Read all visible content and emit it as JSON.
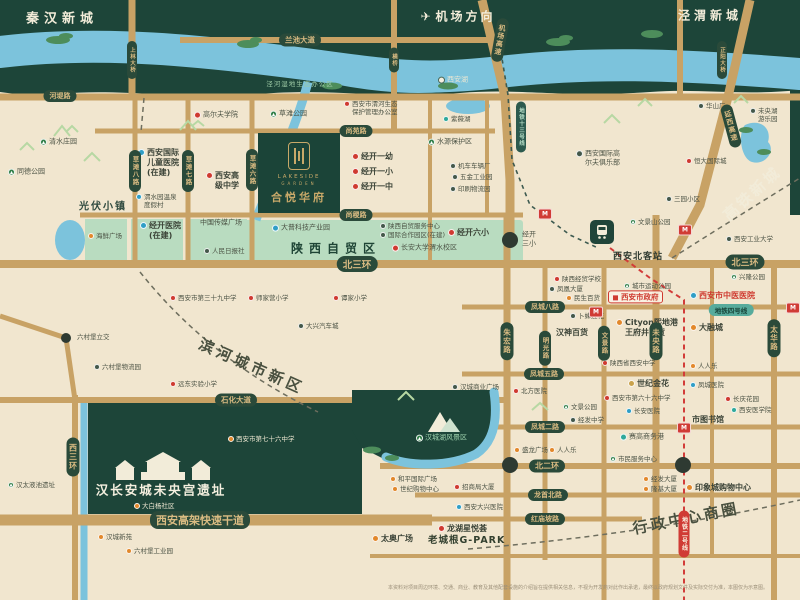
{
  "project": {
    "en_line1": "LAKESIDE",
    "en_line2": "GARDEN",
    "name_cn": "合悦华府"
  },
  "districts": {
    "qinhan": "秦汉新城",
    "jingwei": "泾渭新城",
    "airport_direction": "机场方向",
    "gaotie": "高铁新城",
    "binhe": "滨河城市新区",
    "xingzheng": "行政中心商圈",
    "zimao": "陕西自贸区",
    "guangfu": "光伏小镇",
    "ruins": "汉长安城未央宫遗址",
    "wetland_office": "泾河湿地生态办公区"
  },
  "station": {
    "name": "西安北客站",
    "icon": "train-icon"
  },
  "metro": {
    "line2": "地铁二号线",
    "line4": "地铁四号线",
    "line13": "地铁十三号线",
    "station_icon": "M"
  },
  "colors": {
    "cream": "#f1e6cf",
    "dark_green": "#1d4539",
    "mint": "#b9dcc0",
    "river": "#7cc3dc",
    "road": "#c8a265",
    "pill_green": "#2a4a3a",
    "pill_gold_text": "#d9bb82",
    "metro_red": "#d03b35",
    "metro_teal": "#57ab9c",
    "poi_red": "#cf3a30",
    "poi_orange": "#e2882b",
    "poi_blue": "#2f9ec6"
  },
  "road_pills_horizontal": [
    {
      "t": "兰池大道",
      "x": 300,
      "y": 40,
      "fs": 7.5
    },
    {
      "t": "河堤路",
      "x": 60,
      "y": 96,
      "fs": 7
    },
    {
      "t": "尚苑路",
      "x": 356,
      "y": 131,
      "fs": 7
    },
    {
      "t": "尚稷路",
      "x": 356,
      "y": 215,
      "fs": 7
    },
    {
      "t": "北三环",
      "x": 357,
      "y": 264,
      "fs": 9.5
    },
    {
      "t": "北三环",
      "x": 745,
      "y": 262,
      "fs": 9
    },
    {
      "t": "凤城八路",
      "x": 545,
      "y": 307,
      "fs": 7
    },
    {
      "t": "凤城五路",
      "x": 544,
      "y": 374,
      "fs": 7
    },
    {
      "t": "石化大道",
      "x": 236,
      "y": 400,
      "fs": 7.5
    },
    {
      "t": "凤城二路",
      "x": 545,
      "y": 427,
      "fs": 7
    },
    {
      "t": "北二环",
      "x": 547,
      "y": 466,
      "fs": 8
    },
    {
      "t": "龙首北路",
      "x": 548,
      "y": 495,
      "fs": 7
    },
    {
      "t": "红庙坡路",
      "x": 545,
      "y": 519,
      "fs": 7
    },
    {
      "t": "西安高架快速干道",
      "x": 200,
      "y": 520,
      "fs": 11
    }
  ],
  "road_pills_vertical": [
    {
      "t": "西三环",
      "x": 73,
      "y": 457,
      "fs": 8
    },
    {
      "t": "草滩八路",
      "x": 135,
      "y": 171,
      "fs": 6.5
    },
    {
      "t": "草滩七路",
      "x": 188,
      "y": 171,
      "fs": 6.5
    },
    {
      "t": "草滩六路",
      "x": 252,
      "y": 170,
      "fs": 6.5
    },
    {
      "t": "朱宏路",
      "x": 507,
      "y": 341,
      "fs": 7.5
    },
    {
      "t": "明光路",
      "x": 545,
      "y": 348,
      "fs": 6.5
    },
    {
      "t": "文景路",
      "x": 604,
      "y": 343,
      "fs": 6.5
    },
    {
      "t": "未央路",
      "x": 656,
      "y": 341,
      "fs": 7.5
    },
    {
      "t": "太华路",
      "x": 774,
      "y": 338,
      "fs": 7.5
    }
  ],
  "bridge_pills": [
    {
      "t": "上林大桥",
      "x": 132,
      "y": 60,
      "fs": 5.5
    },
    {
      "t": "横桥",
      "x": 394,
      "y": 60,
      "fs": 5.5
    },
    {
      "t": "正阳大桥",
      "x": 722,
      "y": 60,
      "fs": 5.5
    }
  ],
  "highway_pills": [
    {
      "t": "机场高速",
      "x": 500,
      "y": 40,
      "rot": 10,
      "fs": 7
    },
    {
      "t": "延西高速",
      "x": 731,
      "y": 126,
      "rot": -15,
      "fs": 7
    }
  ],
  "metro_pills": [
    {
      "t": "地铁二号线",
      "x": 684,
      "y": 534,
      "kind": "red",
      "vert": true,
      "fs": 6
    },
    {
      "t": "地铁四号线",
      "x": 731,
      "y": 310,
      "kind": "teal",
      "vert": false,
      "fs": 6.5
    },
    {
      "t": "地铁十三号线",
      "x": 521,
      "y": 127,
      "kind": "dteal",
      "vert": true,
      "fs": 5.5
    }
  ],
  "metro_stations": [
    [
      545,
      214
    ],
    [
      685,
      230
    ],
    [
      596,
      312
    ],
    [
      793,
      308
    ],
    [
      684,
      428
    ]
  ],
  "pois": [
    {
      "t": "清水庄园",
      "x": 40,
      "y": 142,
      "c": "green",
      "s": "sm"
    },
    {
      "t": "同德公园",
      "x": 8,
      "y": 172,
      "c": "green",
      "s": "sm"
    },
    {
      "t": "草滩公园",
      "x": 270,
      "y": 114,
      "c": "green",
      "s": "sm"
    },
    {
      "t": "高尔夫学院",
      "x": 194,
      "y": 115,
      "c": "red",
      "s": "sm"
    },
    {
      "L": [
        "西安国际",
        "儿童医院",
        "(在建)"
      ],
      "x": 138,
      "y": 163,
      "c": "blue",
      "s": "md"
    },
    {
      "L": [
        "西安高",
        "级中学"
      ],
      "x": 206,
      "y": 181,
      "c": "red",
      "s": "md"
    },
    {
      "L": [
        "渭水园温泉",
        "度假村"
      ],
      "x": 136,
      "y": 201,
      "c": "blue",
      "s": "xs"
    },
    {
      "t": "海鲜广场",
      "x": 88,
      "y": 236,
      "c": "orange",
      "s": "xs"
    },
    {
      "L": [
        "经开医院",
        "(在建)"
      ],
      "x": 140,
      "y": 231,
      "c": "blue",
      "s": "md"
    },
    {
      "t": "中国传媒广场",
      "x": 200,
      "y": 223,
      "c": "none",
      "s": "sm"
    },
    {
      "t": "人民日报社",
      "x": 204,
      "y": 251,
      "c": "dark",
      "s": "xs"
    },
    {
      "L": [
        "西安市渭河生态",
        "保护管理办公室"
      ],
      "x": 344,
      "y": 108,
      "c": "red",
      "s": "xs"
    },
    {
      "t": "西安湖",
      "x": 438,
      "y": 80,
      "c": "white",
      "s": "sm",
      "d": true
    },
    {
      "t": "紫薇湖",
      "x": 443,
      "y": 119,
      "c": "teal",
      "s": "xs"
    },
    {
      "t": "水源保护区",
      "x": 428,
      "y": 142,
      "c": "green",
      "s": "sm"
    },
    {
      "t": "机车车辆厂",
      "x": 450,
      "y": 166,
      "c": "dark",
      "s": "xs"
    },
    {
      "t": "五金工业园",
      "x": 452,
      "y": 177,
      "c": "dark",
      "s": "xs"
    },
    {
      "t": "印刷物流园",
      "x": 450,
      "y": 189,
      "c": "dark",
      "s": "xs"
    },
    {
      "L": [
        "西安国际高",
        "尔夫俱乐部"
      ],
      "x": 576,
      "y": 158,
      "c": "dark",
      "s": "sm"
    },
    {
      "L": [
        "未央湖",
        "游乐园"
      ],
      "x": 750,
      "y": 115,
      "c": "dark",
      "s": "xs"
    },
    {
      "t": "华山厂",
      "x": 698,
      "y": 106,
      "c": "dark",
      "s": "xs"
    },
    {
      "t": "恒大国际城",
      "x": 686,
      "y": 161,
      "c": "red",
      "s": "xs"
    },
    {
      "t": "三园小区",
      "x": 666,
      "y": 199,
      "c": "dark",
      "s": "xs"
    },
    {
      "t": "西安工业大学",
      "x": 726,
      "y": 239,
      "c": "dark",
      "s": "xs"
    },
    {
      "t": "经开一幼",
      "x": 352,
      "y": 157,
      "c": "red",
      "s": "md"
    },
    {
      "t": "经开一小",
      "x": 352,
      "y": 172,
      "c": "red",
      "s": "md"
    },
    {
      "t": "经开一中",
      "x": 352,
      "y": 187,
      "c": "red",
      "s": "md"
    },
    {
      "t": "经开六小",
      "x": 448,
      "y": 233,
      "c": "red",
      "s": "md"
    },
    {
      "t": "长安大学渭水校区",
      "x": 392,
      "y": 248,
      "c": "red",
      "s": "sm"
    },
    {
      "t": "大普科技产业园",
      "x": 272,
      "y": 228,
      "c": "blue",
      "s": "sm"
    },
    {
      "t": "陕西自贸服务中心",
      "x": 380,
      "y": 226,
      "c": "dark",
      "s": "xs"
    },
    {
      "t": "国际合作园区(在建)",
      "x": 380,
      "y": 235,
      "c": "dark",
      "s": "xs"
    },
    {
      "L": [
        "经开",
        "三小"
      ],
      "x": 522,
      "y": 239,
      "c": "none",
      "s": "sm"
    },
    {
      "t": "文景山公园",
      "x": 630,
      "y": 222,
      "c": "green",
      "s": "xs"
    },
    {
      "t": "陕西经贸学校",
      "x": 554,
      "y": 279,
      "c": "red",
      "s": "xs"
    },
    {
      "t": "凤凰大厦",
      "x": 549,
      "y": 289,
      "c": "dark",
      "s": "xs"
    },
    {
      "t": "民生百货",
      "x": 566,
      "y": 298,
      "c": "orange",
      "s": "xs"
    },
    {
      "t": "卜蜂莲花",
      "x": 570,
      "y": 316,
      "c": "dark",
      "s": "xs"
    },
    {
      "t": "汉神百货",
      "x": 556,
      "y": 333,
      "c": "none",
      "s": "md"
    },
    {
      "t": "城市运动公园",
      "x": 624,
      "y": 286,
      "c": "green",
      "s": "xs"
    },
    {
      "t": "西安市政府",
      "x": 608,
      "y": 297,
      "c": "govt",
      "s": "govt"
    },
    {
      "t": "西安市中医医院",
      "x": 690,
      "y": 296,
      "c": "blue",
      "s": "redmd"
    },
    {
      "t": "兴隆公园",
      "x": 731,
      "y": 277,
      "c": "green",
      "s": "xs"
    },
    {
      "L": [
        "Cityon熙地港",
        "王府井百货"
      ],
      "x": 616,
      "y": 328,
      "c": "orange",
      "s": "md"
    },
    {
      "t": "大融城",
      "x": 690,
      "y": 328,
      "c": "orange",
      "s": "md"
    },
    {
      "t": "人人乐",
      "x": 690,
      "y": 366,
      "c": "orange",
      "s": "xs"
    },
    {
      "t": "陕西省西安中学",
      "x": 602,
      "y": 363,
      "c": "red",
      "s": "xs"
    },
    {
      "t": "世纪金花",
      "x": 628,
      "y": 384,
      "c": "goldc",
      "s": "md"
    },
    {
      "t": "凤城医院",
      "x": 690,
      "y": 385,
      "c": "blue",
      "s": "xs"
    },
    {
      "t": "长安医院",
      "x": 626,
      "y": 411,
      "c": "blue",
      "s": "xs"
    },
    {
      "t": "西安市第六十六中学",
      "x": 604,
      "y": 398,
      "c": "red",
      "s": "xs"
    },
    {
      "t": "长庆花园",
      "x": 725,
      "y": 399,
      "c": "red",
      "s": "xs"
    },
    {
      "t": "西安医学院",
      "x": 731,
      "y": 410,
      "c": "teal",
      "s": "xs"
    },
    {
      "t": "市图书馆",
      "x": 692,
      "y": 420,
      "c": "none",
      "s": "md"
    },
    {
      "t": "赛高商务港",
      "x": 620,
      "y": 437,
      "c": "teal",
      "s": "sm"
    },
    {
      "t": "市民服务中心",
      "x": 610,
      "y": 459,
      "c": "green",
      "s": "xs"
    },
    {
      "t": "经发大厦",
      "x": 643,
      "y": 479,
      "c": "orange",
      "s": "xs"
    },
    {
      "t": "隆基大厦",
      "x": 643,
      "y": 489,
      "c": "orange",
      "s": "xs"
    },
    {
      "t": "印象城购物中心",
      "x": 686,
      "y": 488,
      "c": "orange",
      "s": "md"
    },
    {
      "t": "西安市第三十九中学",
      "x": 170,
      "y": 298,
      "c": "red",
      "s": "xs"
    },
    {
      "t": "师家营小学",
      "x": 248,
      "y": 298,
      "c": "red",
      "s": "xs"
    },
    {
      "t": "谭家小学",
      "x": 333,
      "y": 298,
      "c": "red",
      "s": "xs"
    },
    {
      "t": "大兴汽车城",
      "x": 298,
      "y": 326,
      "c": "dark",
      "s": "xs"
    },
    {
      "t": "六村堡立交",
      "x": 77,
      "y": 337,
      "c": "none",
      "s": "xs"
    },
    {
      "t": "六村堡物流园",
      "x": 94,
      "y": 367,
      "c": "dark",
      "s": "xs"
    },
    {
      "t": "远东实验小学",
      "x": 170,
      "y": 384,
      "c": "red",
      "s": "xs"
    },
    {
      "t": "汉城商业广场",
      "x": 452,
      "y": 387,
      "c": "dark",
      "s": "xs"
    },
    {
      "t": "北方医院",
      "x": 513,
      "y": 391,
      "c": "red",
      "s": "xs"
    },
    {
      "t": "文景公园",
      "x": 563,
      "y": 407,
      "c": "green",
      "s": "xs"
    },
    {
      "t": "经发中学",
      "x": 570,
      "y": 420,
      "c": "dark",
      "s": "xs"
    },
    {
      "t": "盛龙广场",
      "x": 514,
      "y": 450,
      "c": "orange",
      "s": "xs"
    },
    {
      "t": "人人乐",
      "x": 549,
      "y": 450,
      "c": "orange",
      "s": "xs"
    },
    {
      "t": "和平国际广场",
      "x": 390,
      "y": 479,
      "c": "orange",
      "s": "xs"
    },
    {
      "t": "世纪购物中心",
      "x": 392,
      "y": 489,
      "c": "orange",
      "s": "xs"
    },
    {
      "t": "招商局大厦",
      "x": 454,
      "y": 487,
      "c": "red",
      "s": "xs"
    },
    {
      "t": "西安大兴医院",
      "x": 456,
      "y": 507,
      "c": "blue",
      "s": "xs"
    },
    {
      "t": "龙湖星悦荟",
      "x": 438,
      "y": 529,
      "c": "red",
      "s": "md"
    },
    {
      "t": "老城根G-PARK",
      "x": 428,
      "y": 541,
      "c": "none",
      "s": "lg"
    },
    {
      "t": "太奥广场",
      "x": 372,
      "y": 539,
      "c": "orange",
      "s": "md"
    },
    {
      "t": "汉城新苑",
      "x": 98,
      "y": 537,
      "c": "orange",
      "s": "xs"
    },
    {
      "t": "六村堡工业园",
      "x": 126,
      "y": 551,
      "c": "orange",
      "s": "xs"
    },
    {
      "t": "大白杨社区",
      "x": 134,
      "y": 506,
      "c": "orange",
      "s": "xs",
      "d": true
    },
    {
      "t": "西安市第七十六中学",
      "x": 228,
      "y": 439,
      "c": "orange",
      "s": "xs",
      "d": true
    },
    {
      "t": "汉太液池遗址",
      "x": 8,
      "y": 485,
      "c": "green",
      "s": "xs"
    },
    {
      "t": "汉城湖风景区",
      "x": 416,
      "y": 438,
      "c": "green",
      "s": "sm",
      "d": true,
      "grn": true
    }
  ],
  "disclaimer": "本资料对项目周边环境、交通、商业、教育及其他配套设施的介绍旨在提供相关信息，不视为开发商对此作出承诺，最终以政府规划文件及实际交付为准，本图仅为示意图。"
}
